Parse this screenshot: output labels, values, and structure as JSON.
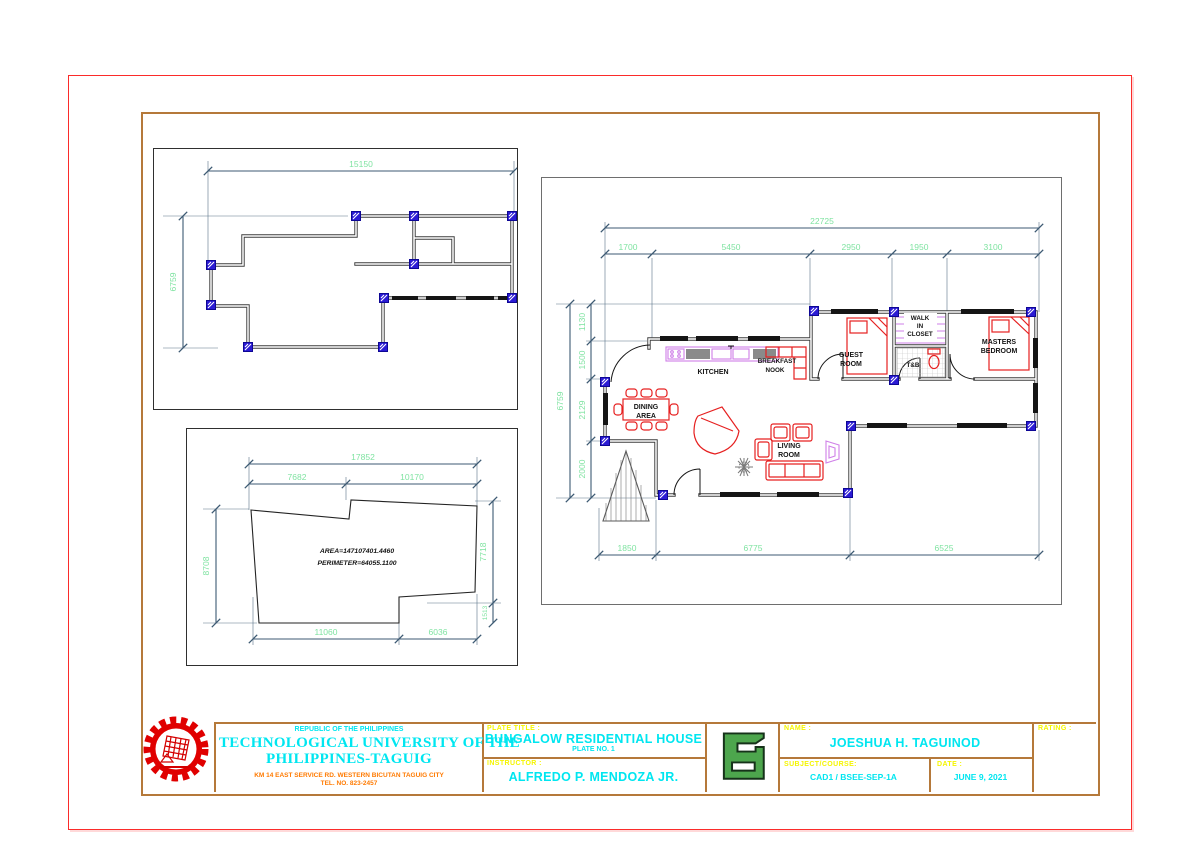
{
  "colors": {
    "border_red": "#fb2b2a",
    "sheet_brown": "#b5793a",
    "dimension_line": "#3d5a73",
    "dimension_text_green": "#7fe3a1",
    "column_marker_blue": "#2b1bd4",
    "furniture_red": "#e62020",
    "fixture_violet": "#cf7fe8",
    "title_cyan": "#00e6f0",
    "label_yellow": "#f5f500",
    "address_orange": "#ff7a00",
    "logo_green": "#4da64d"
  },
  "panel_outline": {
    "width_total": "15150",
    "height_total": "6759"
  },
  "panel_lot": {
    "top_total": "17852",
    "top_left": "7682",
    "top_right": "10170",
    "left": "8708",
    "right": "7718",
    "right_small": "1513",
    "bottom_left": "11060",
    "bottom_right": "6036",
    "area": "AREA=147107401.4460",
    "perimeter": "PERIMETER=64055.1100"
  },
  "panel_plan": {
    "top_total": "22725",
    "top_segments": [
      "1700",
      "5450",
      "2950",
      "1950",
      "3100"
    ],
    "left_total": "6759",
    "left_segments": [
      "1130",
      "1500",
      "2129",
      "2000"
    ],
    "bottom_segments": [
      "1850",
      "6775",
      "6525"
    ],
    "label_kitchen": "KITCHEN",
    "label_breakfast": "BREAKFAST",
    "label_nook": "NOOK",
    "label_dining1": "DINING",
    "label_dining2": "AREA",
    "label_living1": "LIVING",
    "label_living2": "ROOM",
    "label_guest1": "GUEST",
    "label_guest2": "ROOM",
    "label_walk": "WALK",
    "label_in": "IN",
    "label_closet": "CLOSET",
    "label_tb": "T&B",
    "label_masters1": "MASTERS",
    "label_masters2": "BEDROOM"
  },
  "title_block": {
    "republic": "REPUBLIC OF THE PHILIPPINES",
    "university_1": "TECHNOLOGICAL UNIVERSITY OF THE",
    "university_2": "PHILIPPINES-TAGUIG",
    "address_1": "KM 14 EAST SERVICE RD. WESTERN BICUTAN TAGUIG CITY",
    "address_2": "TEL. NO. 823-2457",
    "plate_title_label": "PLATE TITLE :",
    "plate_title": "BUNGALOW RESIDENTIAL HOUSE",
    "plate_no": "PLATE NO. 1",
    "instructor_label": "INSTRUCTOR :",
    "instructor": "ALFREDO P. MENDOZA JR.",
    "name_label": "NAME :",
    "name": "JOESHUA H. TAGUINOD",
    "subject_label": "SUBJECT/COURSE:",
    "subject": "CAD1 / BSEE-SEP-1A",
    "date_label": "DATE :",
    "date": "JUNE 9, 2021",
    "rating_label": "RATING :"
  }
}
